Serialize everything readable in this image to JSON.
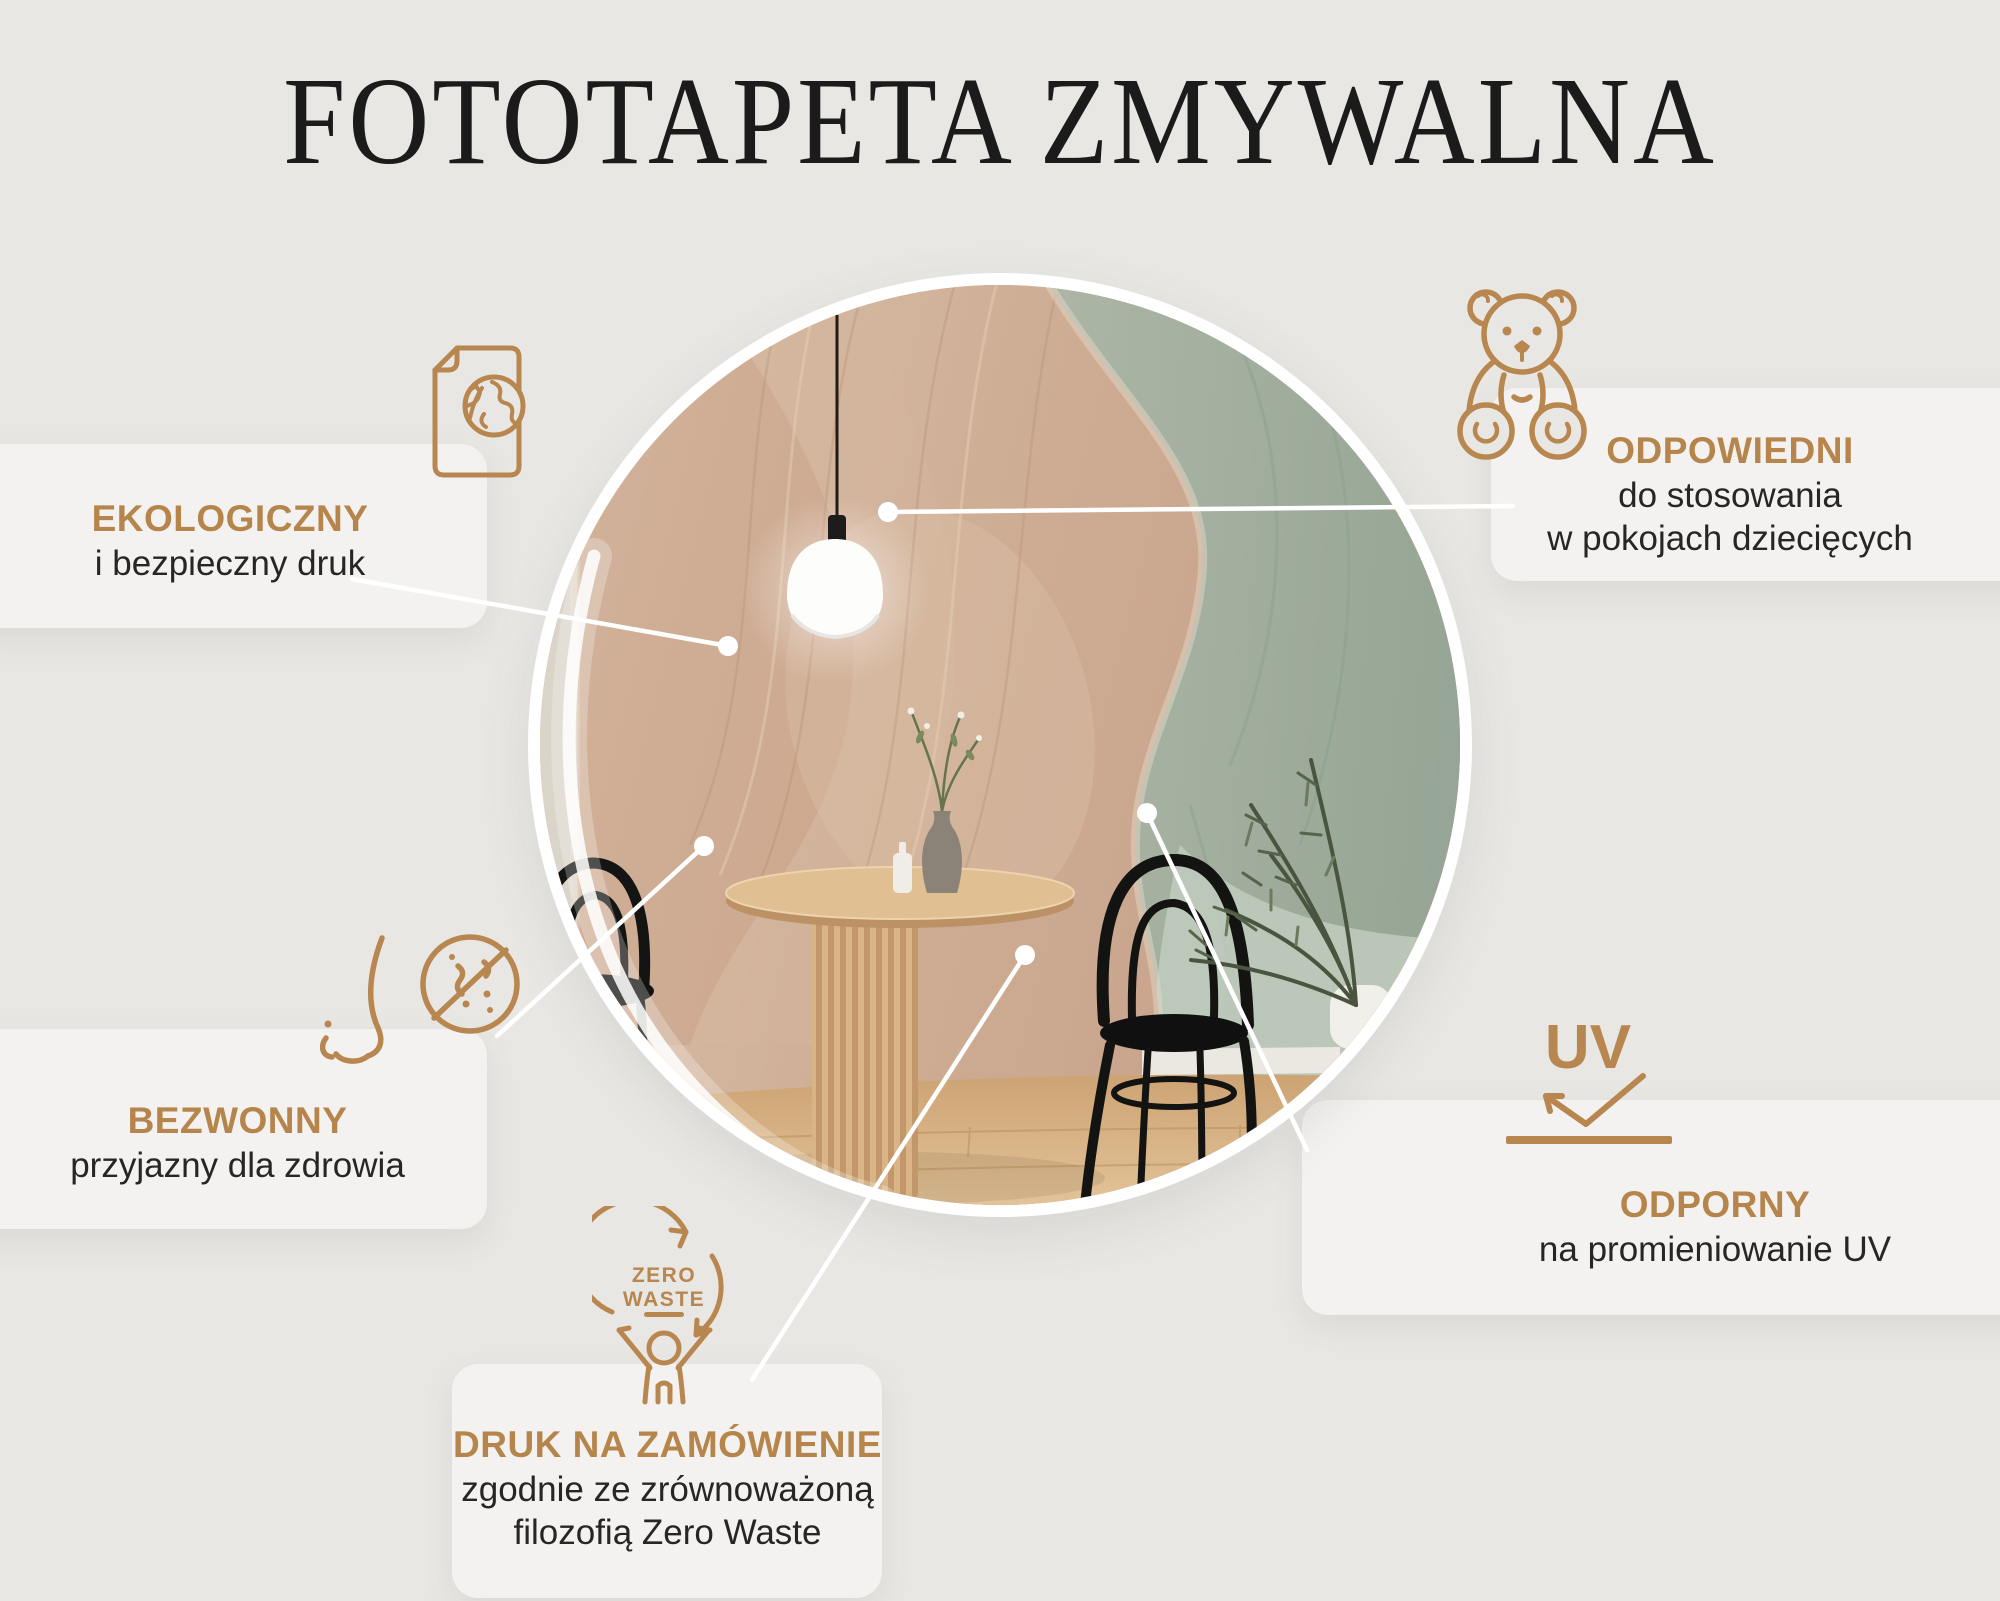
{
  "page": {
    "title": "FOTOTAPETA ZMYWALNA",
    "background_color": "#e8e7e4",
    "panel_color": "#f3f2f0",
    "accent_color": "#b5854c",
    "line_color": "#ffffff"
  },
  "features": [
    {
      "id": "ekologiczny",
      "icon": "eco-paper-globe-icon",
      "title": "EKOLOGICZNY",
      "lines": [
        "i bezpieczny druk"
      ]
    },
    {
      "id": "odpowiedni",
      "icon": "teddy-bear-icon",
      "title": "ODPOWIEDNI",
      "lines": [
        "do stosowania",
        "w pokojach dziecięcych"
      ]
    },
    {
      "id": "bezwonny",
      "icon": "no-odor-nose-icon",
      "title": "BEZWONNY",
      "lines": [
        "przyjazny dla zdrowia"
      ]
    },
    {
      "id": "druk-na-zamowienie",
      "icon": "zero-waste-icon",
      "title": "DRUK NA ZAMÓWIENIE",
      "lines": [
        "zgodnie ze zrównoważoną",
        "filozofią Zero Waste"
      ]
    },
    {
      "id": "odporny",
      "icon": "uv-icon",
      "title": "ODPORNY",
      "lines": [
        "na promieniowanie UV"
      ]
    }
  ],
  "zero_waste_badge": {
    "line1": "ZERO",
    "line2": "WASTE"
  },
  "uv_badge": {
    "label": "UV"
  },
  "photo": {
    "subject": "dining corner with wavy pastel wallpaper, round wooden table, two black bentwood chairs, pendant lamp, vase and plant",
    "wall_pink": "#cfae96",
    "wall_green": "#a3b0a0",
    "floor_wood": "#d2a878"
  }
}
